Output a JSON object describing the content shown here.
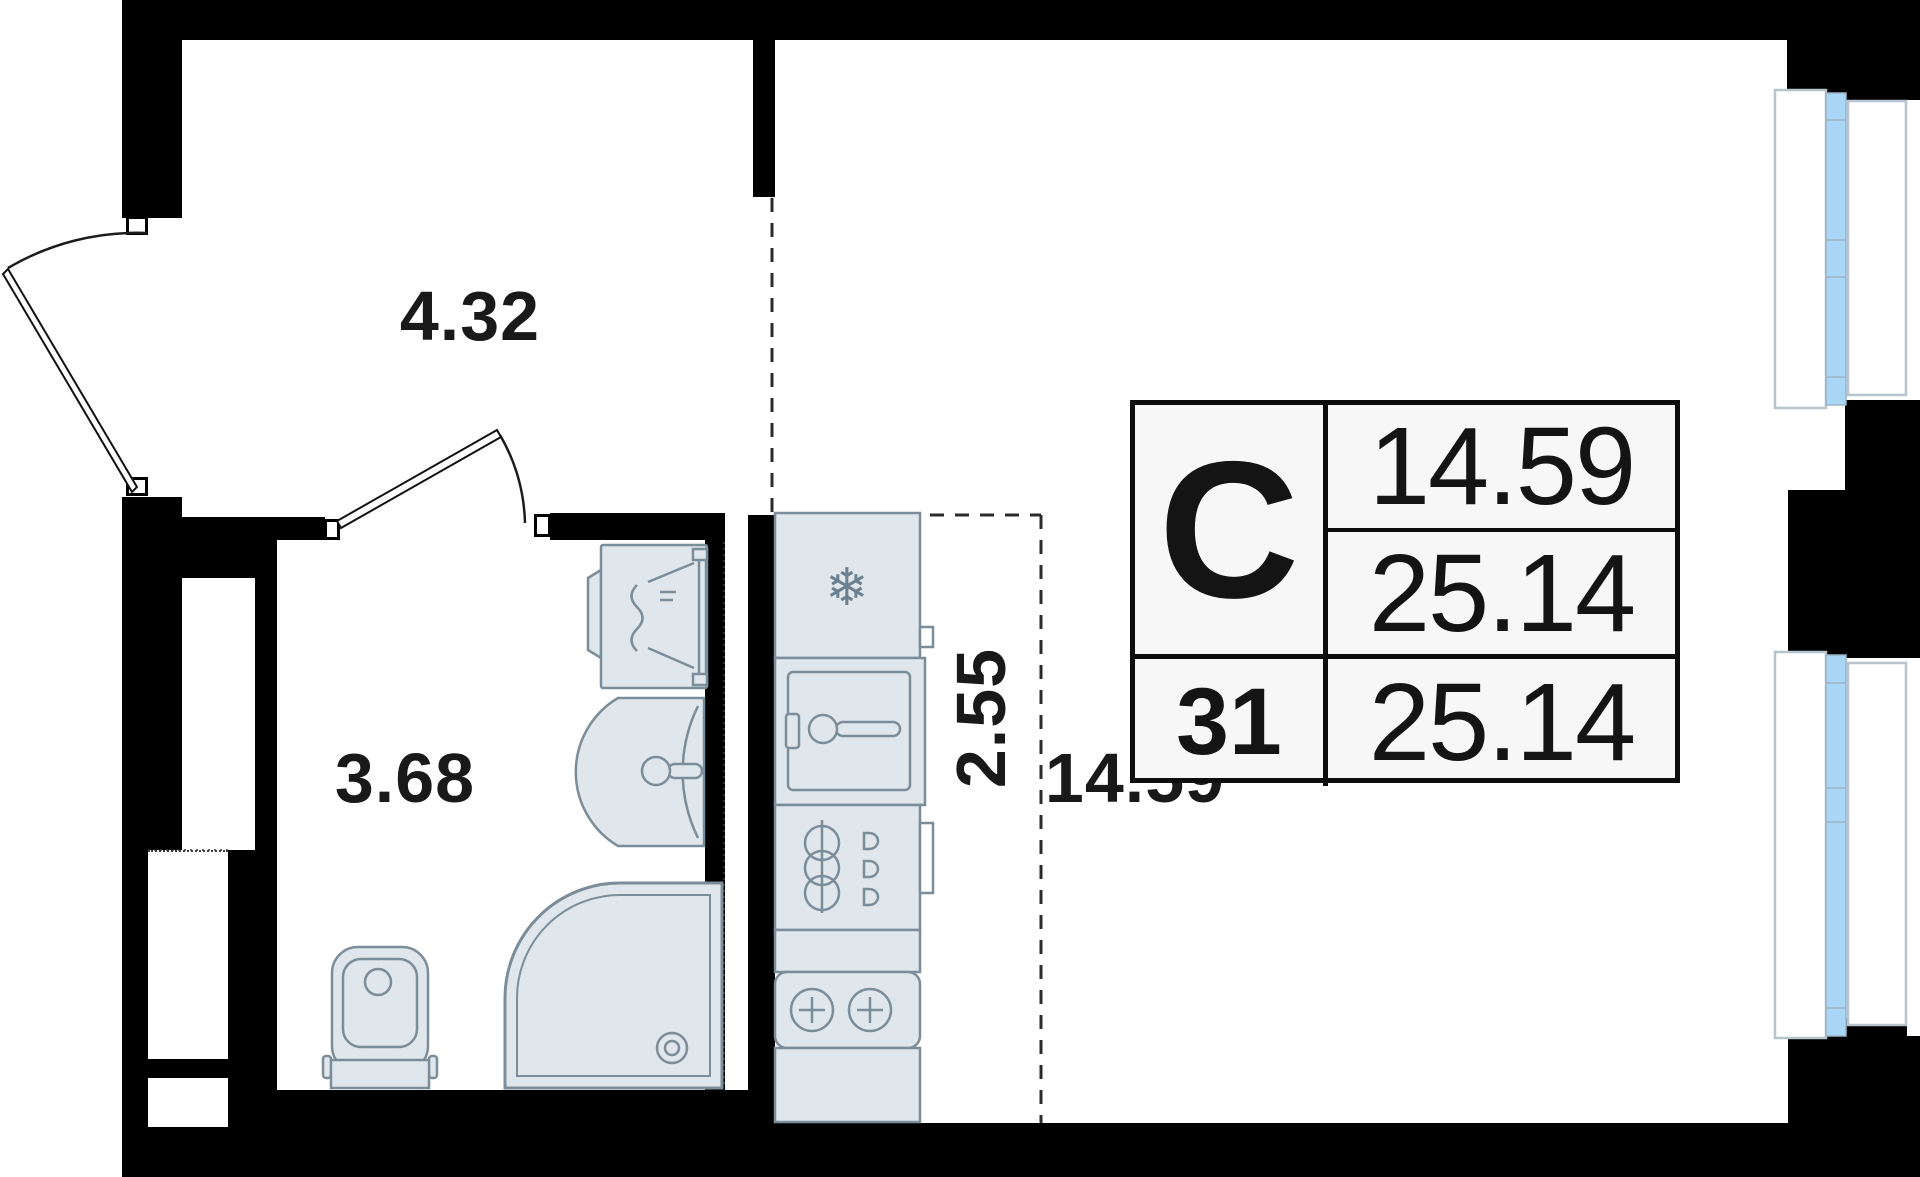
{
  "plan": {
    "labels": {
      "hallway_area": "4.32",
      "bathroom_area": "3.68",
      "kitchen_area": "2.55",
      "living_area": "14.59"
    },
    "info_table": {
      "type_letter": "С",
      "living_area": "14.59",
      "total_area": "25.14",
      "apartment_number": "31",
      "total_area_repeat": "25.14"
    },
    "icons": {
      "snowflake": "❄"
    },
    "colors": {
      "wall": "#000000",
      "fixture_fill": "#dfe6ec",
      "fixture_stroke": "#7c8d9a",
      "window_glass": "#a9d6f4",
      "window_frame": "#b7c3cd",
      "table_background": "#f7f7f7",
      "label_text": "#191919",
      "zone_dash_line": "#2b2b2b"
    }
  }
}
